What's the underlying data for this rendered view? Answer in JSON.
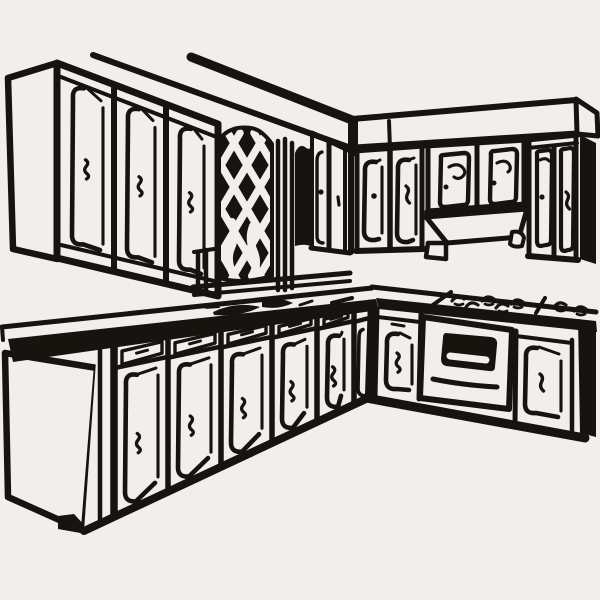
{
  "meta": {
    "title": "Kitchen cabinets line-art illustration",
    "description": "Black-and-white clip-art drawing of an L-shaped kitchen: upper wall cabinets with squiggle handles, a diamond lattice window panel, a soffit band over right-wall cabinets with a range hood, a stovetop with burner marks, an oven with a dark window and handle, and base cabinets with drawers and doors along a cornered countertop with a sink silhouette."
  },
  "palette": {
    "background": "#f0efec",
    "ink": "#17130f"
  },
  "scene": {
    "parts": [
      {
        "id": "ceiling-trim",
        "label": "Ceiling / soffit trim lines"
      },
      {
        "id": "wall-cabinets-left",
        "label": "Upper wall cabinets, left wall",
        "doors": 3
      },
      {
        "id": "lattice-window",
        "label": "Diamond lattice window panel"
      },
      {
        "id": "soffit-right",
        "label": "Soffit band, right wall"
      },
      {
        "id": "wall-cabinets-right",
        "label": "Upper wall cabinets, right wall",
        "doors": 7
      },
      {
        "id": "range-hood",
        "label": "Range hood"
      },
      {
        "id": "countertop",
        "label": "L-shaped countertop"
      },
      {
        "id": "sink",
        "label": "Sink and faucet silhouette"
      },
      {
        "id": "cooktop",
        "label": "Stovetop burner marks",
        "burners": 6
      },
      {
        "id": "oven",
        "label": "Oven with window and handle"
      },
      {
        "id": "base-cabinets-left",
        "label": "Base cabinets with drawers, left run",
        "units": 5
      },
      {
        "id": "base-cabinets-right",
        "label": "Base cabinets, right run"
      }
    ]
  }
}
